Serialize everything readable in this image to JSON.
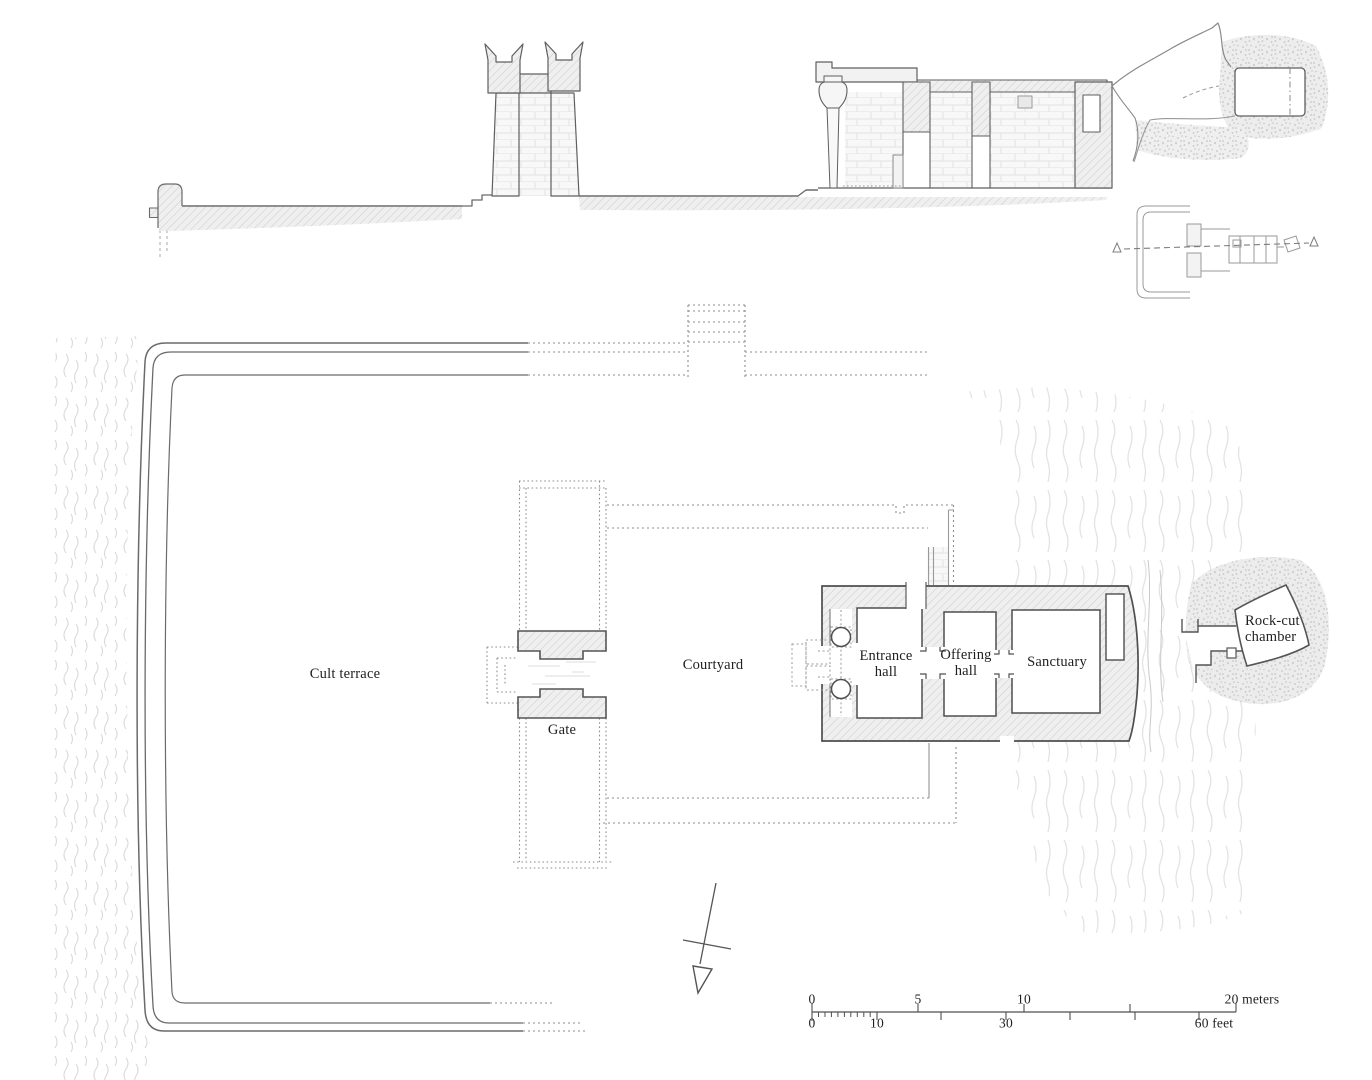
{
  "labels": {
    "cult_terrace": "Cult terrace",
    "gate": "Gate",
    "courtyard": "Courtyard",
    "entrance_hall": "Entrance hall",
    "offering_hall": "Offering hall",
    "sanctuary": "Sanctuary",
    "rock_cut_chamber": "Rock-cut chamber"
  },
  "scale_bar": {
    "meters_ticks": [
      "0",
      "5",
      "10"
    ],
    "meters_end_label": "20 meters",
    "feet_ticks": [
      "0",
      "10",
      "30"
    ],
    "feet_end_label": "60 feet"
  },
  "colors": {
    "line": "#4f4f4f",
    "label_text": "#1f1f1f",
    "wall_fill": "#efeff0",
    "hatch_line": "#c7c7c9",
    "dashed_line": "#8d8d8d",
    "water_line": "#d9d9d9"
  }
}
